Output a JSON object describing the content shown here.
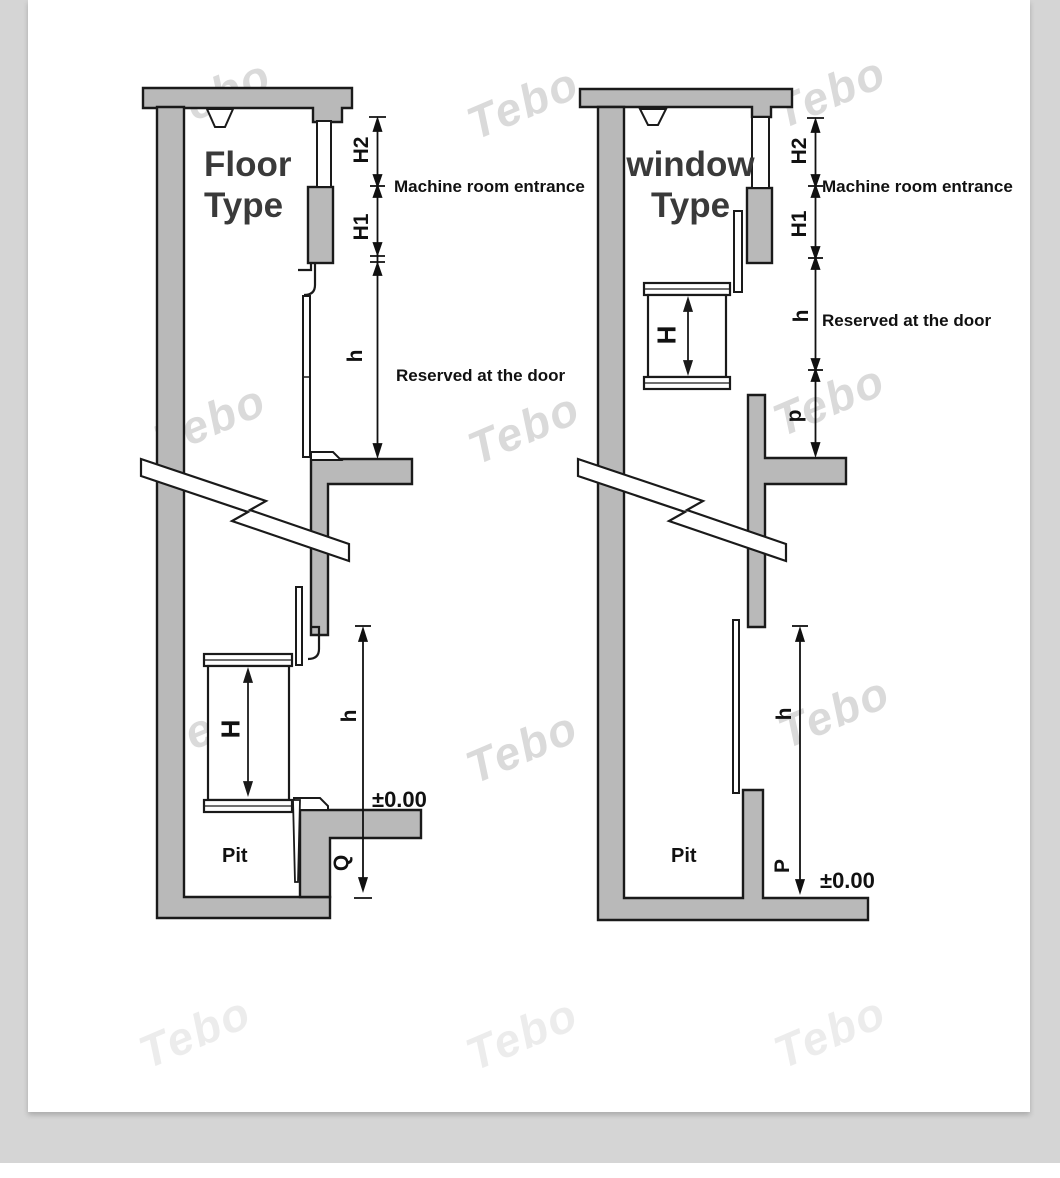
{
  "watermark": {
    "text": "Tebo"
  },
  "colors": {
    "background": "#d5d5d5",
    "card": "#ffffff",
    "structure_fill": "#b9b9b9",
    "line": "#1a1a1a"
  },
  "diagrams": {
    "left": {
      "title": {
        "line1": "Floor",
        "line2": "Type"
      },
      "labels": {
        "h2": "H2",
        "h1": "H1",
        "door_height": "h",
        "cabin_height": "H",
        "travel_height": "h",
        "pit_depth": "Q",
        "machine_room": "Machine room entrance",
        "reserved_door": "Reserved at the door",
        "pit": "Pit",
        "zero_level": "±0.00"
      }
    },
    "right": {
      "title": {
        "line1": "window",
        "line2": "Type"
      },
      "labels": {
        "h2": "H2",
        "h1": "H1",
        "door_height": "h",
        "slab_offset": "p",
        "cabin_height": "H",
        "travel_height": "h",
        "pit_depth": "P",
        "machine_room": "Machine room entrance",
        "reserved_door": "Reserved at the door",
        "pit": "Pit",
        "zero_level": "±0.00"
      }
    }
  }
}
